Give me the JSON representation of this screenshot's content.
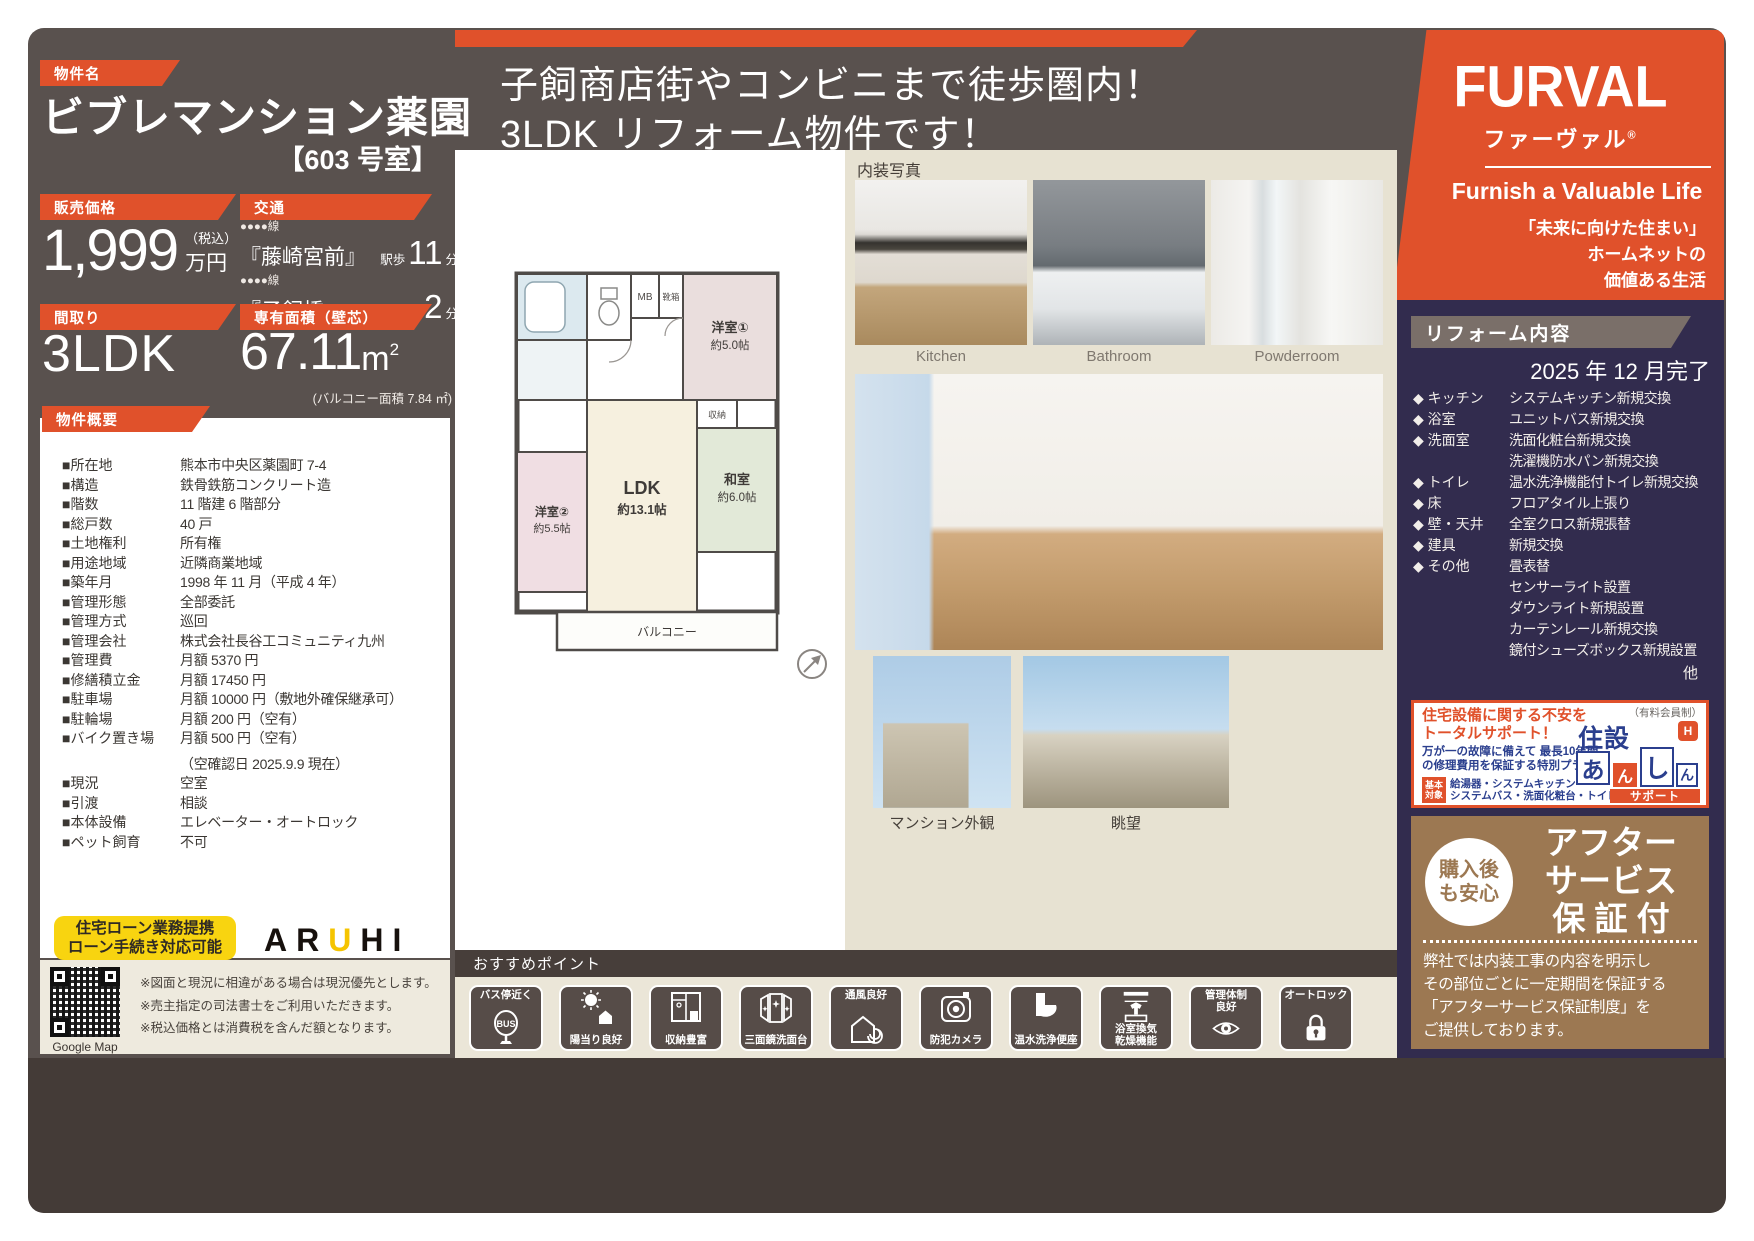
{
  "property": {
    "tag": "物件名",
    "name": "ビブレマンション薬園",
    "room": "【603 号室】"
  },
  "headline": {
    "line1": "子飼商店街やコンビニまで徒歩圏内！",
    "line2": "3LDK リフォーム物件です！"
  },
  "price": {
    "tag": "販売価格",
    "value": "1,999",
    "tax": "（税込）",
    "unit": "万円"
  },
  "access": {
    "tag": "交通",
    "routes": [
      {
        "line": "●●●●線",
        "station": "『藤崎宮前』",
        "mode": "駅歩",
        "min": "11",
        "unit": "分"
      },
      {
        "line": "●●●●線",
        "station": "『子飼橋』",
        "mode": "停歩",
        "min": "2",
        "unit": "分"
      }
    ]
  },
  "madori": {
    "tag": "間取り",
    "value": "3LDK"
  },
  "menseki": {
    "tag": "専有面積（壁芯）",
    "value": "67.11",
    "unit": "m",
    "sup": "2",
    "balcony": "(バルコニー面積 7.84 ㎡)"
  },
  "overview": {
    "tag": "物件概要",
    "rows": [
      {
        "k": "■所在地",
        "v": "熊本市中央区薬園町 7-4"
      },
      {
        "k": "■構造",
        "v": "鉄骨鉄筋コンクリート造"
      },
      {
        "k": "■階数",
        "v": "11 階建 6 階部分"
      },
      {
        "k": "■総戸数",
        "v": "40 戸"
      },
      {
        "k": "■土地権利",
        "v": "所有権"
      },
      {
        "k": "■用途地域",
        "v": "近隣商業地域"
      },
      {
        "k": "■築年月",
        "v": "1998 年 11 月（平成 4 年）"
      },
      {
        "k": "■管理形態",
        "v": "全部委託"
      },
      {
        "k": "■管理方式",
        "v": "巡回"
      },
      {
        "k": "■管理会社",
        "v": "株式会社長谷工コミュニティ九州"
      },
      {
        "k": "■管理費",
        "v": "月額 5370 円"
      },
      {
        "k": "■修繕積立金",
        "v": "月額 17450 円"
      },
      {
        "k": "■駐車場",
        "v": "月額 10000 円（敷地外確保継承可）"
      },
      {
        "k": "■駐輪場",
        "v": "月額 200 円（空有）"
      },
      {
        "k": "■バイク置き場",
        "v": "月額 500 円（空有）"
      },
      {
        "k": "",
        "v": "（空確認日 2025.9.9 現在）"
      },
      {
        "k": "■現況",
        "v": "空室"
      },
      {
        "k": "■引渡",
        "v": "相談"
      },
      {
        "k": "■本体設備",
        "v": "エレベーター・オートロック"
      },
      {
        "k": "■ペット飼育",
        "v": "不可"
      }
    ]
  },
  "loan": {
    "line1": "住宅ローン業務提携",
    "line2": "ローン手続き対応可能",
    "bank_a": "AR",
    "bank_u": "U",
    "bank_hi": "HI"
  },
  "map": {
    "caption": "Google Map"
  },
  "notes": [
    "※図面と現況に相違がある場合は現況優先とします。",
    "※売主指定の司法書士をご利用いただきます。",
    "※税込価格とは消費税を含んだ額となります。"
  ],
  "floorplan": {
    "mb": "MB",
    "shoe": "靴箱",
    "closet": "収納",
    "balcony": "バルコニー",
    "rooms": {
      "y1": {
        "name": "洋室①",
        "size": "約5.0帖"
      },
      "y2": {
        "name": "洋室②",
        "size": "約5.5帖"
      },
      "ldk": {
        "name": "LDK",
        "size": "約13.1帖"
      },
      "washitsu": {
        "name": "和室",
        "size": "約6.0帖"
      }
    }
  },
  "photos": {
    "section": "内装写真",
    "top": [
      "Kitchen",
      "Bathroom",
      "Powderroom"
    ],
    "bottom": [
      "マンション外観",
      "眺望"
    ]
  },
  "brand": {
    "logo": "FURVAL",
    "kana": "ファーヴァル",
    "reg": "®",
    "tagline": "Furnish a Valuable Life",
    "slogan1": "「未来に向けた住まい」",
    "slogan2": "ホームネットの",
    "slogan3": "価値ある生活"
  },
  "reform": {
    "tag": "リフォーム内容",
    "completion": "2025 年 12 月完了",
    "items": [
      {
        "k": "◆ キッチン",
        "v": [
          "システムキッチン新規交換"
        ]
      },
      {
        "k": "◆ 浴室",
        "v": [
          "ユニットバス新規交換"
        ]
      },
      {
        "k": "◆ 洗面室",
        "v": [
          "洗面化粧台新規交換",
          "洗濯機防水パン新規交換"
        ]
      },
      {
        "k": "◆ トイレ",
        "v": [
          "温水洗浄機能付トイレ新規交換"
        ]
      },
      {
        "k": "◆ 床",
        "v": [
          "フロアタイル上張り"
        ]
      },
      {
        "k": "◆ 壁・天井",
        "v": [
          "全室クロス新規張替"
        ]
      },
      {
        "k": "◆ 建具",
        "v": [
          "新規交換"
        ]
      },
      {
        "k": "◆ その他",
        "v": [
          "畳表替",
          "センサーライト設置",
          "ダウンライト新規設置",
          "カーテンレール新規交換",
          "鏡付シューズボックス新規設置"
        ]
      }
    ],
    "etc": "他"
  },
  "support": {
    "head1": "住宅設備に関する不安を",
    "head2": "トータルサポート！",
    "desc": "万が一の故障に備えて 最長10年間\nの修理費用を保証する特別プラン",
    "badge": "基本\n対象",
    "badge_text": "給湯器・システムキッチン\nシステムバス・洗面化粧台・トイレ",
    "membership": "（有料会員制）",
    "logo_jusetsu": "住設",
    "logo_a": "あ",
    "logo_n1": "ん",
    "logo_shi": "し",
    "logo_n2": "ん",
    "logo_support": "サポート",
    "logo_h": "H"
  },
  "warranty": {
    "circle": "購入後\nも安心",
    "title1": "アフター",
    "title2": "サービス",
    "title3": "保 証 付",
    "body": "弊社では内装工事の内容を明示し\nその部位ごとに一定期間を保証する\n「アフターサービス保証制度」を\nご提供しております。"
  },
  "points": {
    "tag": "おすすめポイント",
    "items": [
      {
        "label": "バス停近く",
        "sub": "BUS"
      },
      {
        "label": "陽当り良好"
      },
      {
        "label": "収納豊富"
      },
      {
        "label": "三面鏡洗面台"
      },
      {
        "label": "通風良好"
      },
      {
        "label": "防犯カメラ"
      },
      {
        "label": "温水洗浄便座"
      },
      {
        "label": "浴室換気\n乾燥機能"
      },
      {
        "label": "管理体制\n良好"
      },
      {
        "label": "オートロック"
      }
    ]
  }
}
